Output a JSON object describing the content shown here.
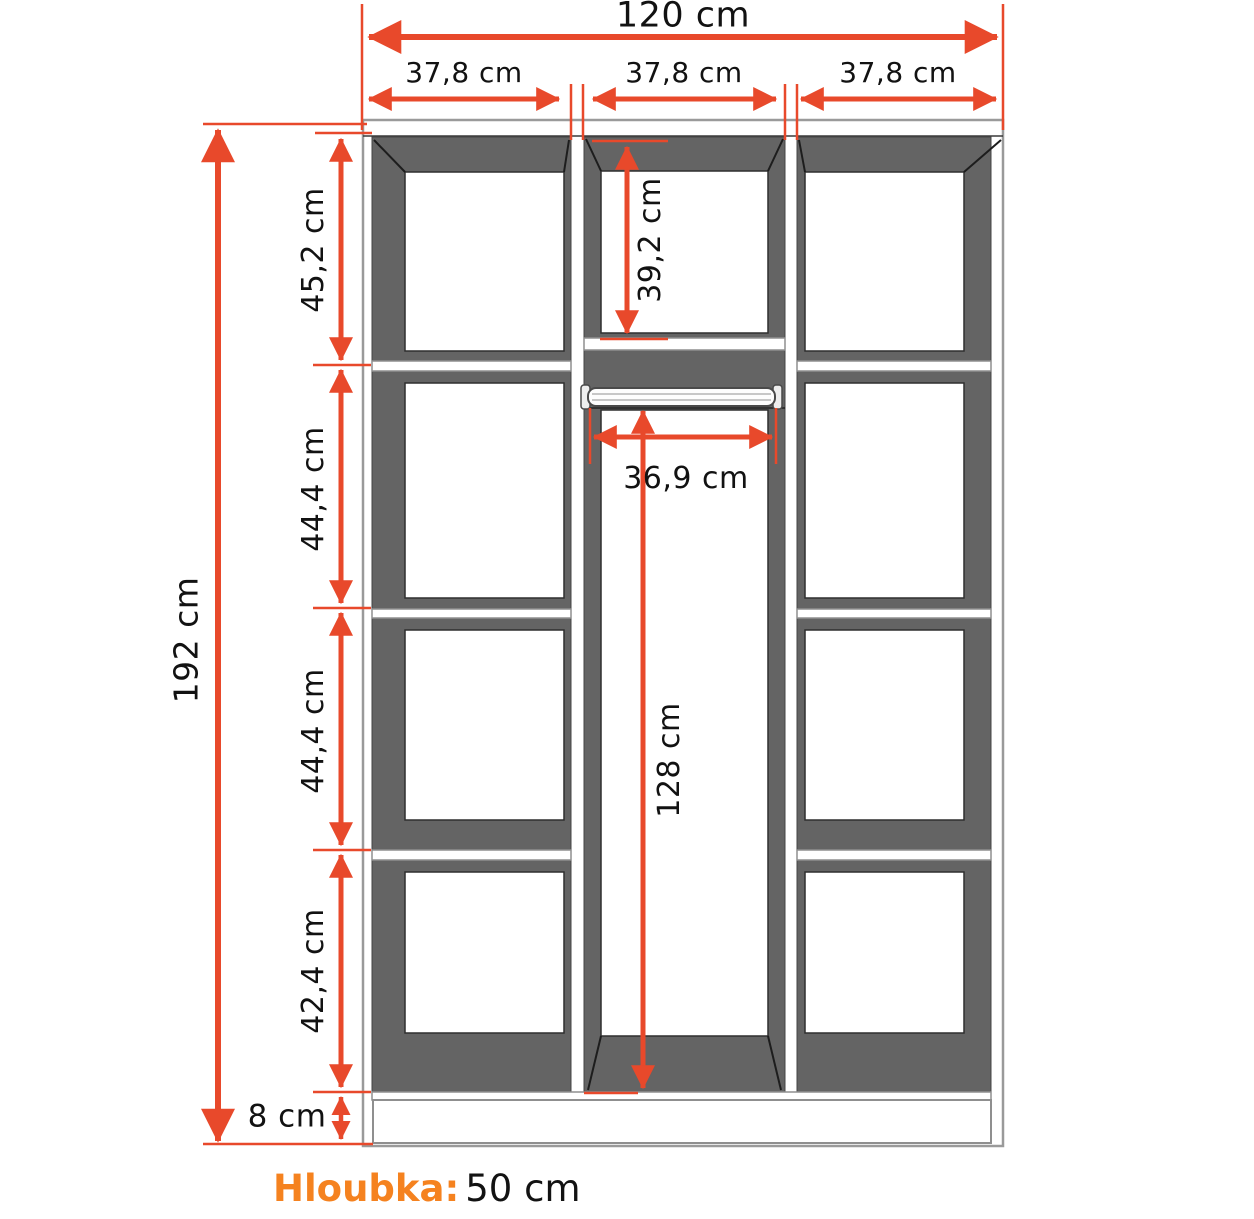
{
  "colors": {
    "accent": "#e8492b",
    "depth_label_orange": "#f5821f",
    "cabinet_dark": "#646464"
  },
  "labels": {
    "total_width": "120 cm",
    "column_widths": [
      "37,8 cm",
      "37,8 cm",
      "37,8 cm"
    ],
    "total_height": "192 cm",
    "left_sections": [
      "45,2 cm",
      "44,4 cm",
      "44,4 cm",
      "42,4 cm"
    ],
    "plinth_height": "8 cm",
    "middle_top_section": "39,2 cm",
    "rod_width": "36,9 cm",
    "hanging_height": "128 cm",
    "depth_label": "Hloubka:",
    "depth_value": "50 cm"
  }
}
